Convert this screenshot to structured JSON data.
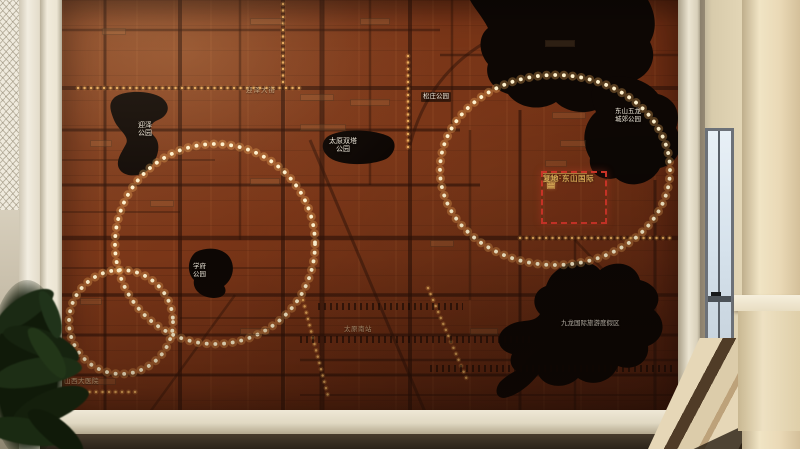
{
  "project": {
    "name": "复地·东山国际",
    "logo": "crown-icon"
  },
  "parks": {
    "yingze": "迎泽公园",
    "shuangta": "太原双塔公园",
    "songzhuang": "松庄公园",
    "dongshan_wulong": "东山五龙城郊公园",
    "xuefu": "学府公园",
    "jiulong": "九龙国际旅游度假区"
  },
  "places": {
    "yingze_street": "迎泽大街",
    "taiyuan_south_station": "太原南站",
    "shanxi_hospital": "山西大医院"
  },
  "colors": {
    "board_wood": "#7a3618",
    "park_black": "#0d0704",
    "led_bright": "#fff2cf",
    "led_amber": "#e5a95b",
    "accent_red": "#d8372a",
    "gold": "#dcab56",
    "frame_cream": "#ece5d3"
  }
}
